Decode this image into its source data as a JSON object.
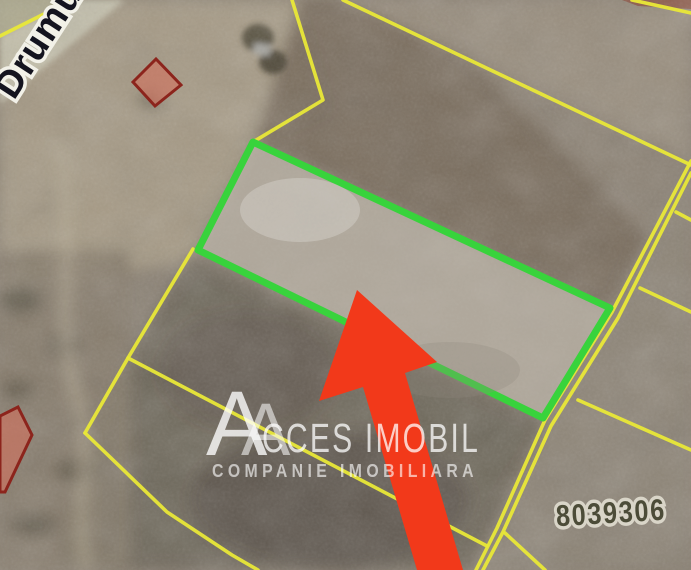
{
  "map": {
    "road_label": "Drumul",
    "parcel_number": "8039306",
    "boundary_color": "#e9e838",
    "highlight_color": "#38d33c",
    "restricted_fill": "#d4705c",
    "restricted_stroke": "#8c241c"
  },
  "watermark": {
    "logo_letter": "A",
    "brand_text": "CCES IMOBIL",
    "tagline": "COMPANIE IMOBILIARA"
  },
  "arrow": {
    "color": "#f2391a"
  }
}
